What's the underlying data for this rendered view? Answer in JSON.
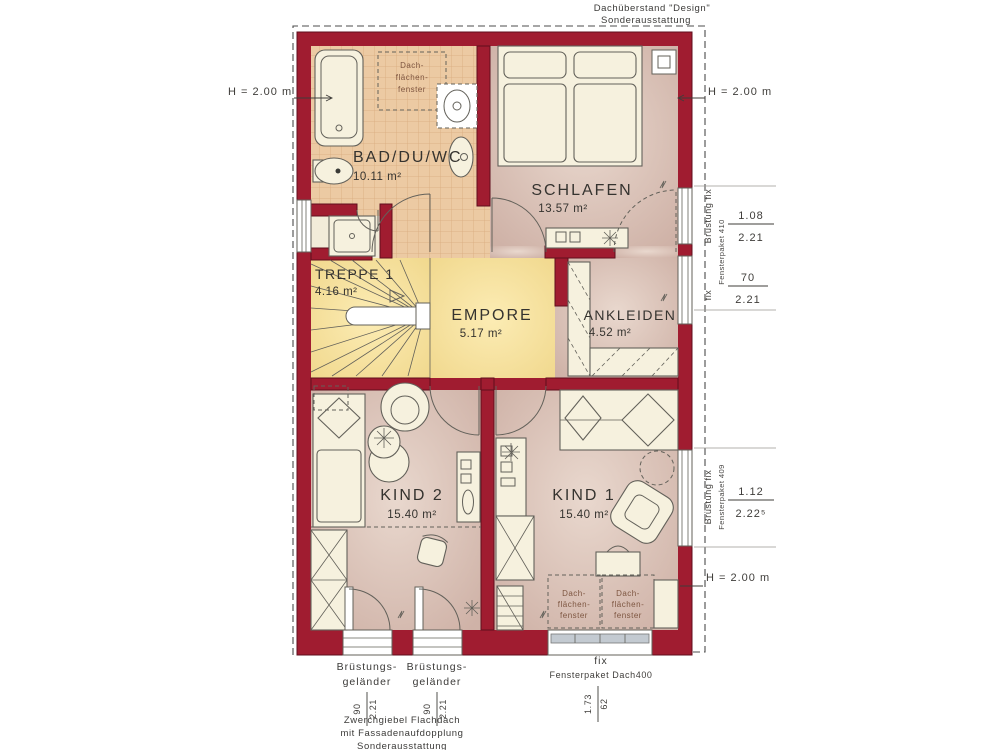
{
  "colors": {
    "wall": "#a01c30",
    "wallEdge": "#5f0e1d",
    "tile": "#eccaa3",
    "tileLine": "#d8ab7e",
    "floor1": "#e9d8ce",
    "floor2": "#cfb2a7",
    "yellow1": "#fcecb4",
    "yellow2": "#f0d78b",
    "furn": "#f6f1de",
    "line": "#63615a",
    "ink": "#35332f",
    "dim": "#3f3d3a",
    "outline": "#4c4c4c",
    "winGray": "#c3cad1",
    "skyText": "#7d5540",
    "shower": "#f2ecd9"
  },
  "notes": {
    "roof1": "Dachüberstand \"Design\"",
    "roof2": "Sonderausstattung",
    "bottom1": "Zwerchgiebel Flachdach",
    "bottom2": "mit Fassadenaufdopplung",
    "bottom3": "Sonderausstattung"
  },
  "heights": {
    "left": "H = 2.00 m",
    "right_top": "H = 2.00 m",
    "right_bottom": "H = 2.00 m"
  },
  "rooms": {
    "bad": {
      "name": "BAD/DU/WC",
      "area": "10.11 m²"
    },
    "schlafen": {
      "name": "SCHLAFEN",
      "area": "13.57 m²"
    },
    "treppe": {
      "name": "TREPPE 1",
      "area": "4.16 m²"
    },
    "empore": {
      "name": "EMPORE",
      "area": "5.17 m²"
    },
    "ankleiden": {
      "name": "ANKLEIDEN",
      "area": "4.52 m²"
    },
    "kind2": {
      "name": "KIND 2",
      "area": "15.40 m²"
    },
    "kind1": {
      "name": "KIND 1",
      "area": "15.40 m²"
    }
  },
  "skylight": {
    "l1": "Dach-",
    "l2": "flächen-",
    "l3": "fenster"
  },
  "windows": {
    "right_upper": {
      "label": "Brüstung fix",
      "label_fix": "fix",
      "paket": "Fensterpaket 410",
      "dim1_w": "1.08",
      "dim1_h": "2.21",
      "dim2_w": "70",
      "dim2_h": "2.21"
    },
    "right_lower": {
      "label": "Brüstung fix",
      "paket": "Fensterpaket 409",
      "dim_w": "1.12",
      "dim_h": "2.22⁵"
    },
    "balcony": {
      "label1": "Brüstungs-",
      "label2": "geländer",
      "dim_w": "90",
      "dim_h": "2.21"
    },
    "bottom_fix": {
      "label": "fix",
      "paket": "Fensterpaket Dach400",
      "dim_w": "1.73",
      "dim_h": "62"
    }
  }
}
